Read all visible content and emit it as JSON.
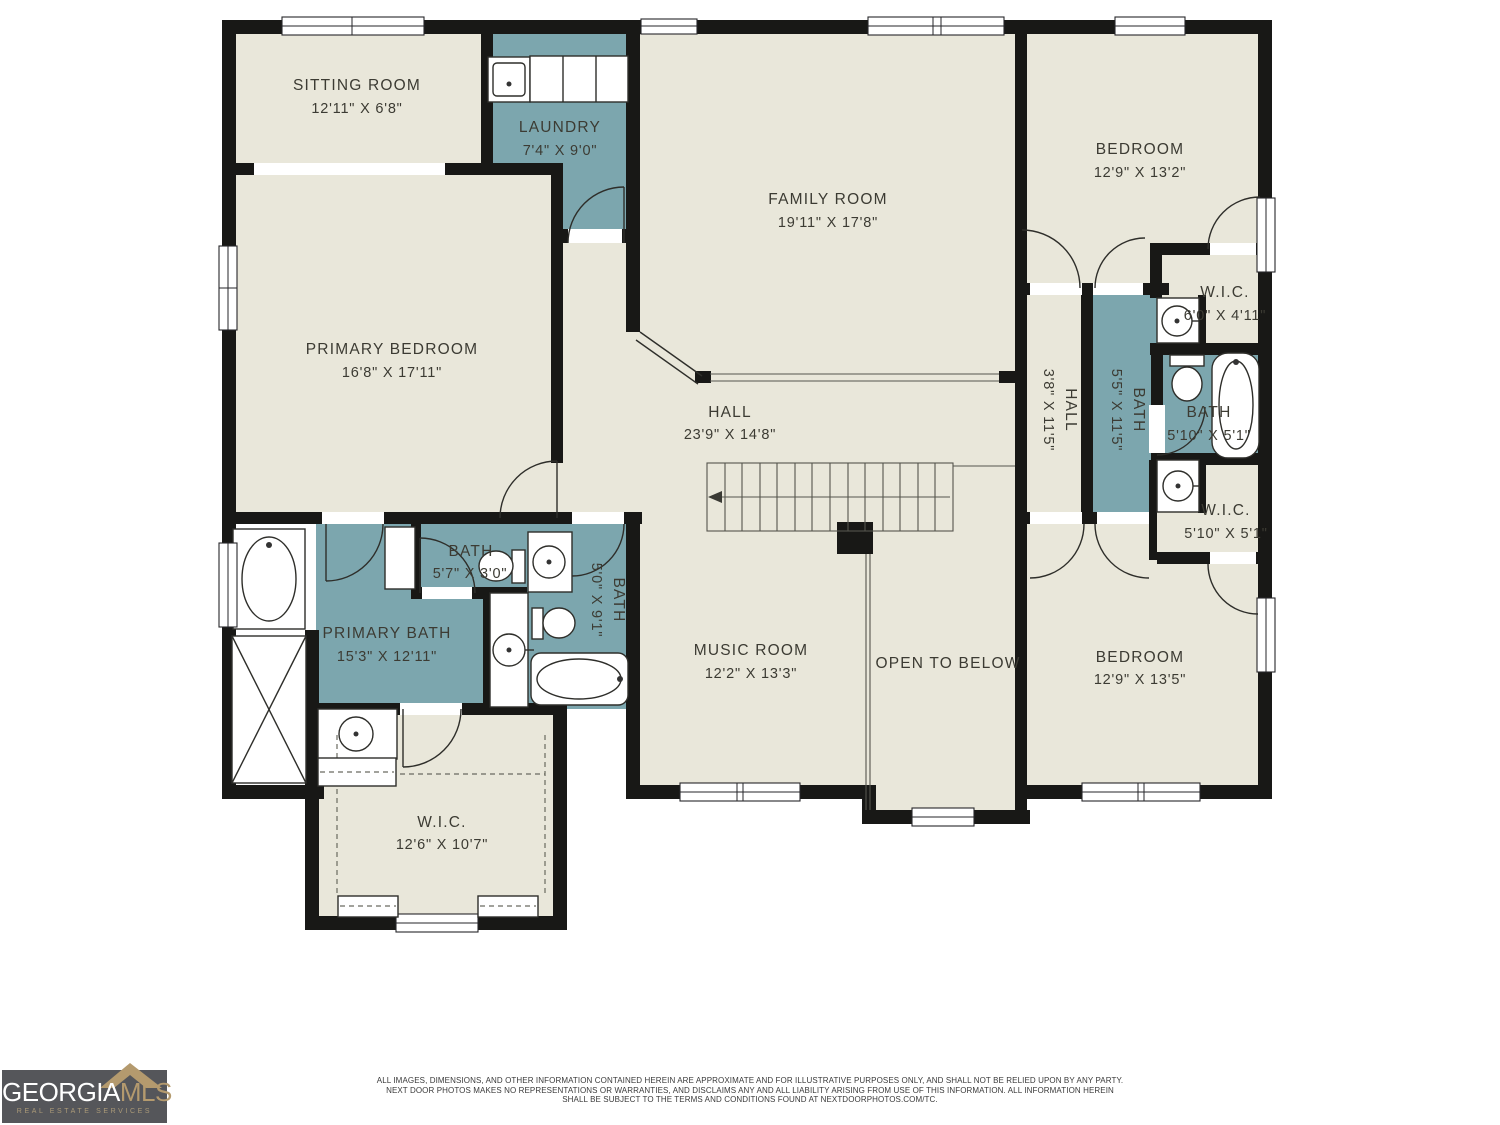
{
  "colors": {
    "wall": "#181816",
    "room_fill": "#e9e7da",
    "wet_room_fill": "#7ca6ae",
    "logo_bg": "#55565a",
    "logo_gold": "#b49a6e"
  },
  "rooms": [
    {
      "id": "sitting-room",
      "name": "SITTING ROOM",
      "dims": "12'11\" X 6'8\""
    },
    {
      "id": "laundry",
      "name": "LAUNDRY",
      "dims": "7'4\" X 9'0\""
    },
    {
      "id": "family-room",
      "name": "FAMILY ROOM",
      "dims": "19'11\" X 17'8\""
    },
    {
      "id": "bedroom-top",
      "name": "BEDROOM",
      "dims": "12'9\" X 13'2\""
    },
    {
      "id": "wic-top",
      "name": "W.I.C.",
      "dims": "6'0\" X 4'11\""
    },
    {
      "id": "hall-upper",
      "name": "HALL",
      "dims": "3'8\" X 11'5\""
    },
    {
      "id": "bath-55",
      "name": "BATH",
      "dims": "5'5\" X 11'5\""
    },
    {
      "id": "bath-small",
      "name": "BATH",
      "dims": "5'10\" X 5'1\""
    },
    {
      "id": "wic-right",
      "name": "W.I.C.",
      "dims": "5'10\" X 5'1\""
    },
    {
      "id": "primary-bedroom",
      "name": "PRIMARY BEDROOM",
      "dims": "16'8\" X 17'11\""
    },
    {
      "id": "hall-main",
      "name": "HALL",
      "dims": "23'9\" X 14'8\""
    },
    {
      "id": "music-room",
      "name": "MUSIC ROOM",
      "dims": "12'2\" X 13'3\""
    },
    {
      "id": "open-to-below",
      "name": "OPEN TO BELOW",
      "dims": ""
    },
    {
      "id": "bedroom-bottom",
      "name": "BEDROOM",
      "dims": "12'9\" X 13'5\""
    },
    {
      "id": "primary-bath",
      "name": "PRIMARY BATH",
      "dims": "15'3\" X 12'11\""
    },
    {
      "id": "bath-57",
      "name": "BATH",
      "dims": "5'7\" X 3'0\""
    },
    {
      "id": "bath-50",
      "name": "BATH",
      "dims": "5'0\" X 9'1\""
    },
    {
      "id": "wic-left",
      "name": "W.I.C.",
      "dims": "12'6\" X 10'7\""
    }
  ],
  "footer": {
    "line1": "ALL IMAGES, DIMENSIONS, AND OTHER INFORMATION CONTAINED HEREIN ARE APPROXIMATE AND FOR ILLUSTRATIVE PURPOSES ONLY, AND SHALL NOT BE RELIED UPON BY ANY PARTY.",
    "line2": "NEXT DOOR PHOTOS MAKES NO REPRESENTATIONS OR WARRANTIES, AND DISCLAIMS ANY AND ALL LIABILITY ARISING FROM USE OF THIS INFORMATION. ALL INFORMATION HEREIN",
    "line3": "SHALL BE SUBJECT TO THE TERMS AND CONDITIONS FOUND AT NEXTDOORPHOTOS.COM/TC."
  },
  "logo": {
    "brand_primary": "GEORGIA",
    "brand_secondary": "MLS",
    "tagline": "REAL ESTATE SERVICES"
  }
}
